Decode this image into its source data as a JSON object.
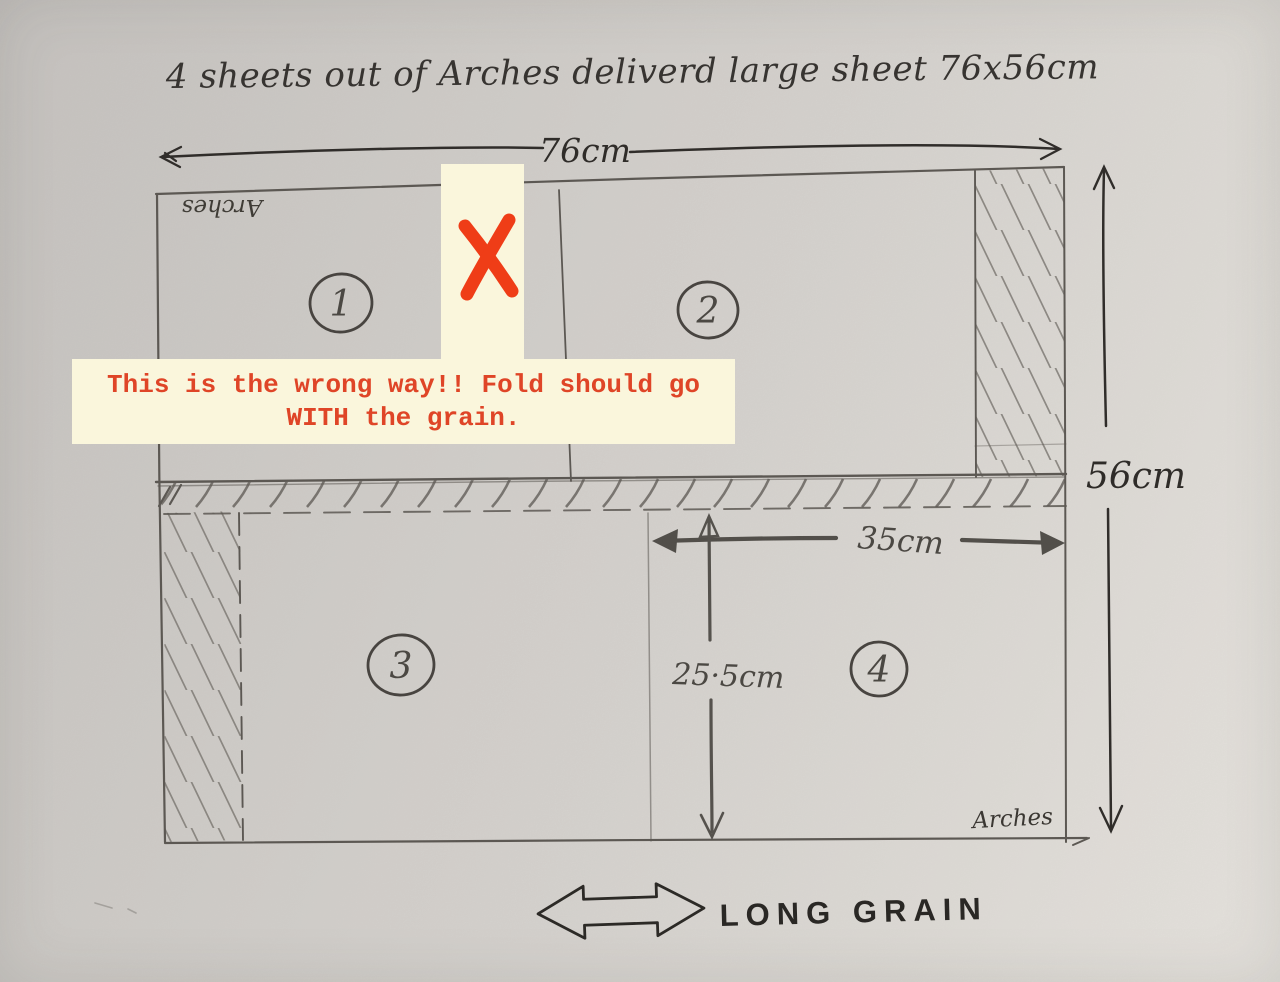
{
  "title": "4 sheets out of Arches deliverd large sheet 76x56cm",
  "dimensions": {
    "sheet_width": "76cm",
    "sheet_height": "56cm",
    "quarter_width": "35cm",
    "quarter_height": "25·5cm"
  },
  "sheets": [
    {
      "number": "1"
    },
    {
      "number": "2"
    },
    {
      "number": "3"
    },
    {
      "number": "4"
    }
  ],
  "watermarks": {
    "top_left": "Arches",
    "bottom_right": "Arches"
  },
  "grain": {
    "label": "LONG GRAIN",
    "arrow_icon": "double-headed-arrow-icon"
  },
  "annotation": {
    "line1": "This is the wrong way!! Fold should go",
    "line2": "WITH the grain.",
    "x_mark_icon": "x-mark-icon",
    "text_color": "#df4527",
    "background_color": "#faf6dc",
    "x_mark_color": "#ef3d17"
  },
  "colors": {
    "paper": "#d2cfca",
    "pencil": "#5f5b56",
    "ink": "#2b2825"
  }
}
